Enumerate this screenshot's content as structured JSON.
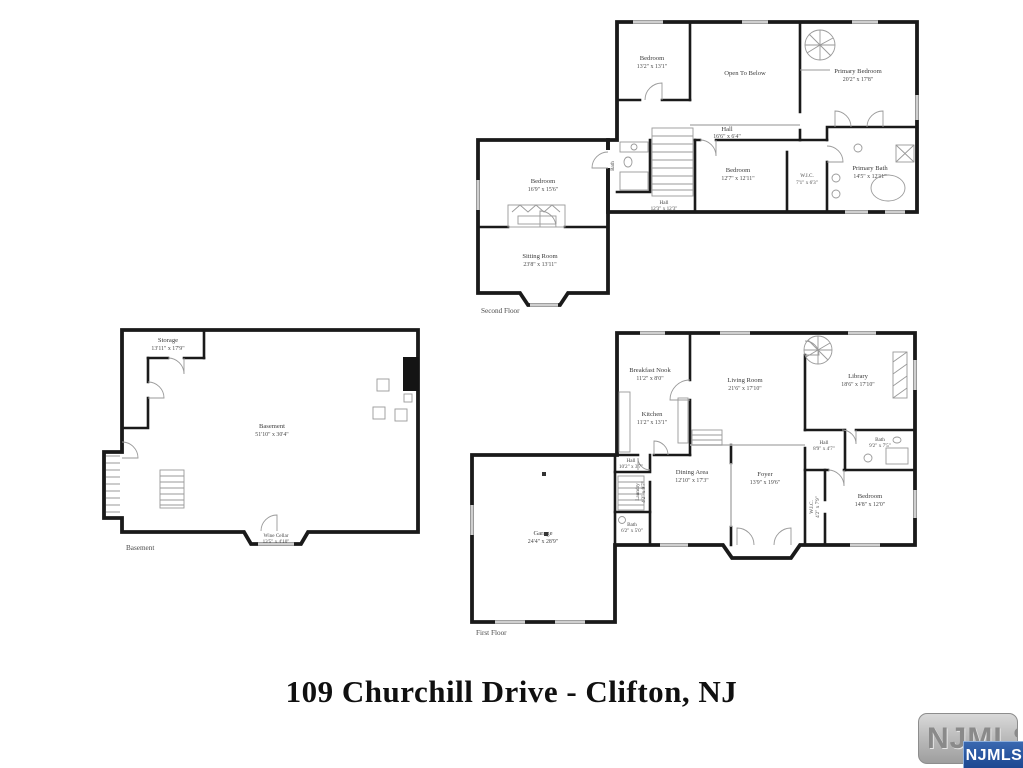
{
  "page": {
    "title": "109 Churchill Drive - Clifton, NJ"
  },
  "watermark": {
    "back_label": "NJMLS",
    "front_label": "NJMLS"
  },
  "floors": {
    "second": {
      "caption": "Second Floor",
      "rooms": {
        "bedroom_top": {
          "name": "Bedroom",
          "dims": "13'2\" x 13'1\""
        },
        "open_to_below": {
          "name": "Open To Below",
          "dims": ""
        },
        "primary_bedroom": {
          "name": "Primary Bedroom",
          "dims": "20'2\" x 17'8\""
        },
        "hall_upper": {
          "name": "Hall",
          "dims": "16'6\" x 6'4\""
        },
        "bedroom_mid": {
          "name": "Bedroom",
          "dims": "12'7\" x 12'11\""
        },
        "wic": {
          "name": "W.I.C.",
          "dims": "7'1\" x 6'3\""
        },
        "primary_bath": {
          "name": "Primary Bath",
          "dims": "14'5\" x 12'11\""
        },
        "bedroom_left": {
          "name": "Bedroom",
          "dims": "16'9\" x 15'6\""
        },
        "sitting_room": {
          "name": "Sitting Room",
          "dims": "23'8\" x 13'11\""
        },
        "hall_lower": {
          "name": "Hall",
          "dims": "12'3\" x 12'3\""
        },
        "bath": {
          "name": "Bath",
          "dims": ""
        }
      }
    },
    "first": {
      "caption": "First Floor",
      "rooms": {
        "breakfast_nook": {
          "name": "Breakfast Nook",
          "dims": "11'2\" x 8'0\""
        },
        "kitchen": {
          "name": "Kitchen",
          "dims": "11'2\" x 13'1\""
        },
        "living_room": {
          "name": "Living Room",
          "dims": "21'6\" x 17'10\""
        },
        "library": {
          "name": "Library",
          "dims": "18'6\" x 17'10\""
        },
        "bath_right": {
          "name": "Bath",
          "dims": "9'2\" x 7'5\""
        },
        "hall_right": {
          "name": "Hall",
          "dims": "8'9\" x 4'7\""
        },
        "dining_area": {
          "name": "Dining Area",
          "dims": "12'10\" x 17'3\""
        },
        "foyer": {
          "name": "Foyer",
          "dims": "13'9\" x 19'6\""
        },
        "bedroom": {
          "name": "Bedroom",
          "dims": "14'8\" x 12'0\""
        },
        "wic": {
          "name": "W.I.C.",
          "dims": "4'2\" x 7'9\""
        },
        "laundry": {
          "name": "Laundry",
          "dims": "4'2\" x 9'7\""
        },
        "bath_left": {
          "name": "Bath",
          "dims": "6'2\" x 5'0\""
        },
        "hall_garage": {
          "name": "Hall",
          "dims": "10'2\" x 3'7\""
        },
        "garage": {
          "name": "Garage",
          "dims": "24'4\" x 28'9\""
        }
      }
    },
    "basement": {
      "caption": "Basement",
      "rooms": {
        "storage": {
          "name": "Storage",
          "dims": "13'11\" x 17'9\""
        },
        "basement": {
          "name": "Basement",
          "dims": "51'10\" x 30'4\""
        },
        "wine_cellar": {
          "name": "Wine Cellar",
          "dims": "13'5\" x 4'10\""
        }
      }
    }
  }
}
